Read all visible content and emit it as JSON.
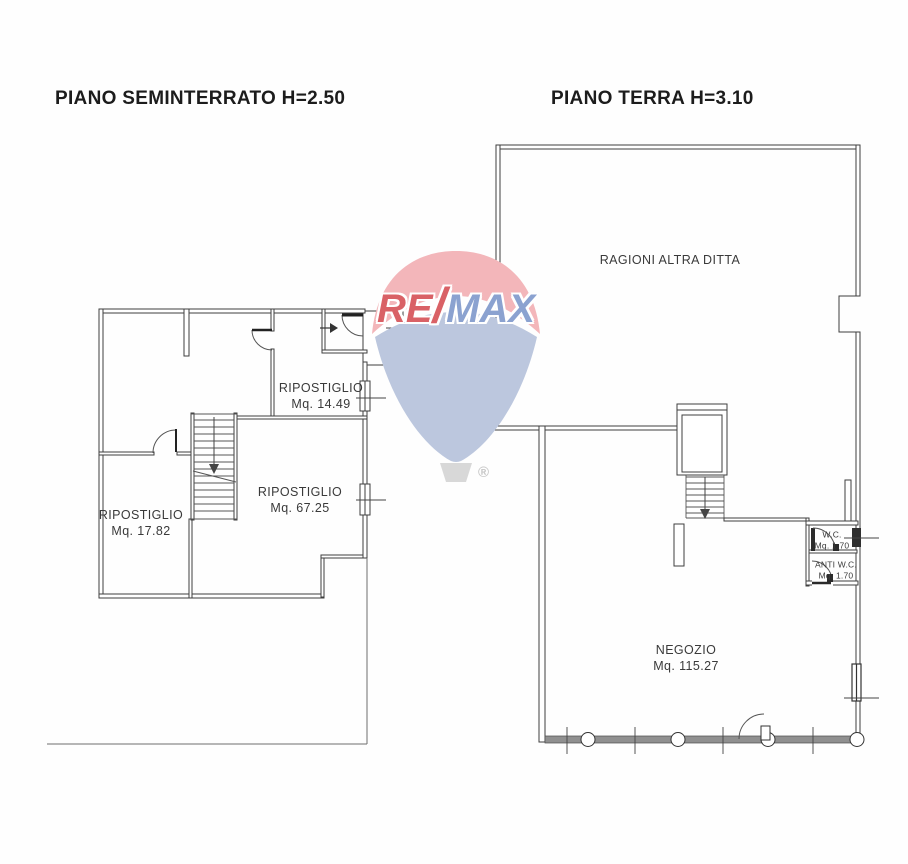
{
  "document_type": "real-estate floor plan",
  "plans": [
    {
      "title": "PIANO SEMINTERRATO H=2.50",
      "rooms": [
        {
          "name": "RIPOSTIGLIO",
          "area": "Mq. 14.49"
        },
        {
          "name": "RIPOSTIGLIO",
          "area": "Mq. 67.25"
        },
        {
          "name": "RIPOSTIGLIO",
          "area": "Mq. 17.82"
        }
      ]
    },
    {
      "title": "PIANO TERRA H=3.10",
      "rooms": [
        {
          "name": "RAGIONI ALTRA DITTA",
          "area": ""
        },
        {
          "name": "NEGOZIO",
          "area": "Mq. 115.27"
        },
        {
          "name": "W.C.",
          "area": "Mq. 1.70"
        },
        {
          "name": "ANTI W.C.",
          "area": "Mq. 1.70"
        }
      ]
    }
  ],
  "watermark": {
    "brand_re": "RE",
    "brand_slash": "/",
    "brand_max": "MAX",
    "registered": "®",
    "colors": {
      "balloon_top": "#f3b6ba",
      "balloon_bottom": "#bcc7de",
      "text_re": "#d96166",
      "text_max": "#8ba2d0",
      "basket": "#d8d8d8"
    }
  },
  "drawing_colors": {
    "wall_line": "#3f3f3f",
    "storefront_fill": "#909090",
    "boundary_line": "#6e6e6e"
  }
}
